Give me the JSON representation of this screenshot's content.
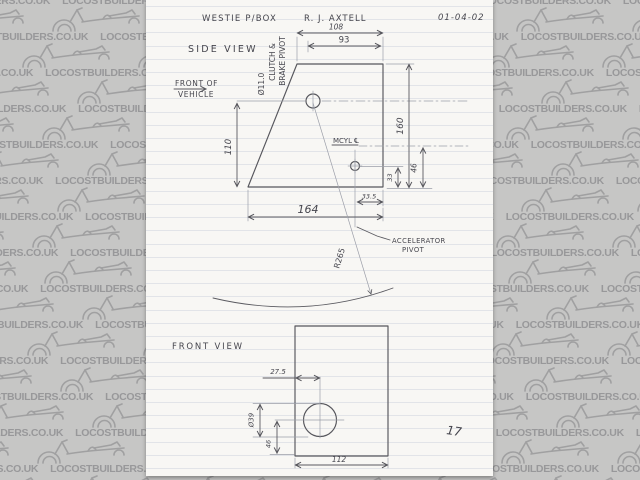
{
  "watermark": {
    "text": "LOCOSTBUILDERS.CO.UK"
  },
  "title_block": {
    "project": "WESTIE P/BOX",
    "author": "R. J. AXTELL",
    "date": "01-04-02",
    "page_number": "17"
  },
  "side_view": {
    "label": "SIDE VIEW",
    "front_of_vehicle": {
      "line1": "FRONT OF",
      "line2": "VEHICLE"
    },
    "pivot_label": {
      "diameter": "Ø11.0",
      "line1": "CLUTCH &",
      "line2": "BRAKE PIVOT"
    },
    "mcyl_label": "MCYL ℄",
    "accelerator_label": {
      "line1": "ACCELERATOR",
      "line2": "PIVOT"
    },
    "radius_label": "R265",
    "dims": {
      "top_width": "108",
      "top_inner_width": "93",
      "overall_height": "160",
      "front_height": "110",
      "bottom_width": "164",
      "mcyl_height": "46",
      "accel_height": "33",
      "accel_offset": "33.5"
    }
  },
  "front_view": {
    "label": "FRONT VIEW",
    "dims": {
      "hole_offset": "27.5",
      "hole_diameter": "Ø39",
      "hole_height": "46",
      "overall_width": "112"
    }
  }
}
